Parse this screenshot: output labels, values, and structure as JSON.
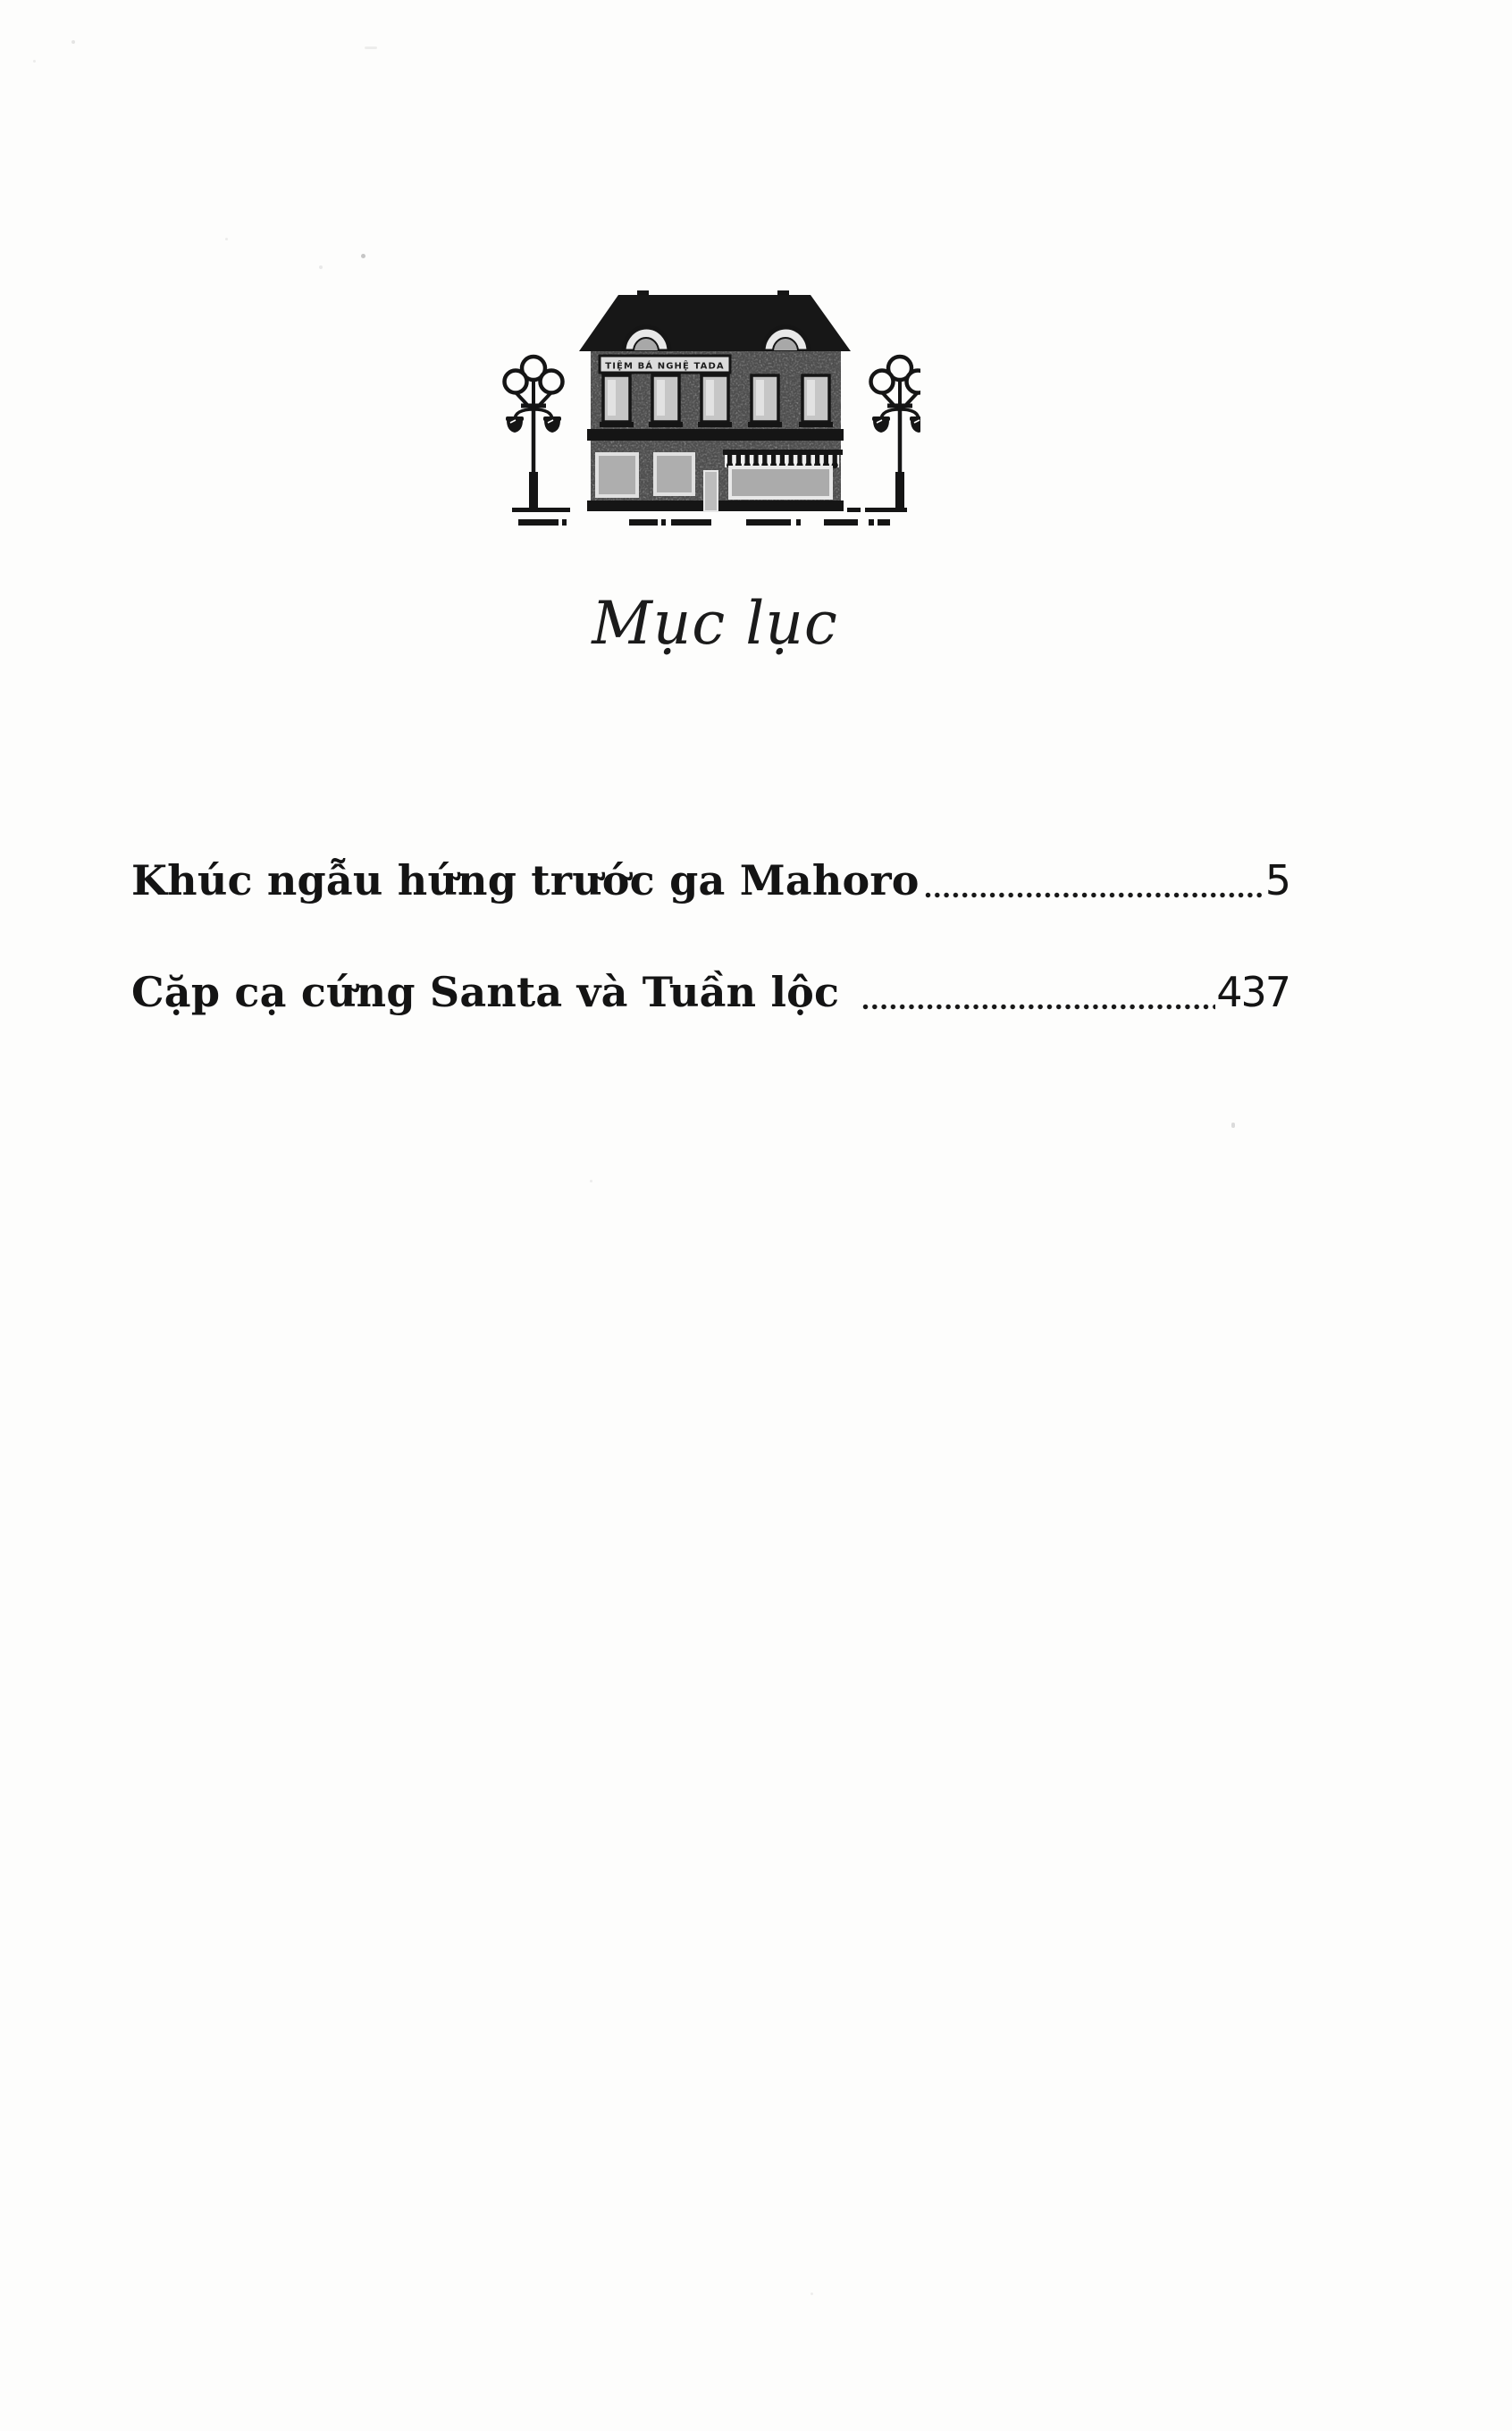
{
  "page_title": "Mục lục",
  "illustration": {
    "description": "two-story shop storefront flanked by two street lamps above a dashed street line",
    "sign_text": "TIỆM BÁ NGHỆ TADA"
  },
  "toc": {
    "entries": [
      {
        "label": "Khúc ngẫu hứng trước ga Mahoro",
        "page_number": "5"
      },
      {
        "label": "Cặp cạ cứng Santa và Tuần lộc",
        "page_number": "437"
      }
    ]
  },
  "colors": {
    "paper": "#fdfdfc",
    "ink": "#161616",
    "wall_gray": "#9c9c9c",
    "window_gray": "#c6c6c6",
    "frame_light": "#e8e8e8"
  }
}
